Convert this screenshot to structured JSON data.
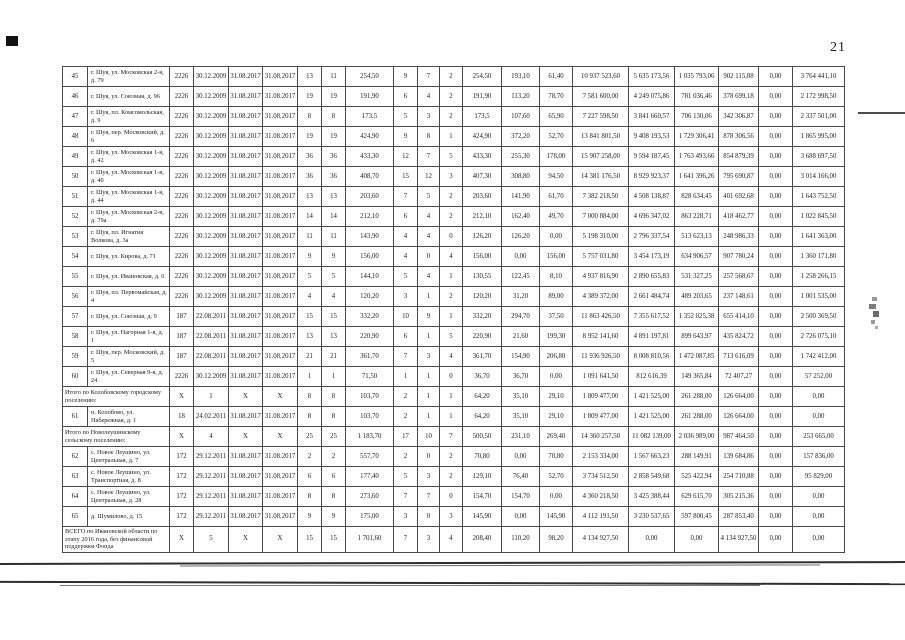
{
  "page": {
    "number": "21"
  },
  "table": {
    "rows": [
      {
        "kind": "data",
        "cells": [
          "45",
          "г. Шуя, ул. Московская 2-я, д. 79",
          "2226",
          "30.12.2009",
          "31.08.2017",
          "31.08.2017",
          "13",
          "11",
          "254,50",
          "9",
          "7",
          "2",
          "254,50",
          "193,10",
          "61,40",
          "10 937 523,60",
          "5 635 173,56",
          "1 035 793,06",
          "902 115,88",
          "0,00",
          "3 764 441,10"
        ]
      },
      {
        "kind": "data",
        "cells": [
          "46",
          "г. Шуя, ул. Союзная, д. 96",
          "2226",
          "30.12.2009",
          "31.08.2017",
          "31.08.2017",
          "19",
          "19",
          "191,90",
          "6",
          "4",
          "2",
          "191,90",
          "113,20",
          "78,70",
          "7 581 600,00",
          "4 249 075,86",
          "781 036,46",
          "378 699,18",
          "0,00",
          "2 172 998,50"
        ]
      },
      {
        "kind": "data",
        "cells": [
          "47",
          "г. Шуя, пл. Комсомольская, д. 9",
          "2226",
          "30.12.2009",
          "31.08.2017",
          "31.08.2017",
          "8",
          "8",
          "173,5",
          "5",
          "3",
          "2",
          "173,5",
          "107,60",
          "65,90",
          "7 227 598,50",
          "3 841 660,57",
          "706 130,06",
          "342 306,87",
          "0,00",
          "2 337 501,00"
        ]
      },
      {
        "kind": "data",
        "cells": [
          "48",
          "г. Шуя, пер. Московский, д. 6",
          "2226",
          "30.12.2009",
          "31.08.2017",
          "31.08.2017",
          "19",
          "19",
          "424,90",
          "9",
          "8",
          "1",
          "424,90",
          "372,20",
          "52,70",
          "13 841 801,50",
          "9 408 193,53",
          "1 729 306,41",
          "878 306,56",
          "0,00",
          "1 865 995,00"
        ]
      },
      {
        "kind": "data",
        "cells": [
          "49",
          "г. Шуя, ул. Московская 1-я, д. 42",
          "2226",
          "30.12.2009",
          "31.08.2017",
          "31.08.2017",
          "36",
          "36",
          "433,30",
          "12",
          "7",
          "5",
          "433,30",
          "255,30",
          "178,00",
          "15 907 258,00",
          "9 594 187,45",
          "1 763 493,66",
          "854 879,39",
          "0,00",
          "3 688 697,50"
        ]
      },
      {
        "kind": "data",
        "cells": [
          "50",
          "г. Шуя, ул. Московская 1-я, д. 40",
          "2226",
          "30.12.2009",
          "31.08.2017",
          "31.08.2017",
          "36",
          "36",
          "408,70",
          "15",
          "12",
          "3",
          "407,30",
          "308,80",
          "94,50",
          "14 381 176,50",
          "8 929 923,37",
          "1 641 396,26",
          "795 690,87",
          "0,00",
          "3 014 166,00"
        ]
      },
      {
        "kind": "data",
        "cells": [
          "51",
          "г. Шуя, ул. Московская 1-я, д. 44",
          "2226",
          "30.12.2009",
          "31.08.2017",
          "31.08.2017",
          "13",
          "13",
          "203,60",
          "7",
          "5",
          "2",
          "203,60",
          "141,90",
          "61,70",
          "7 382 218,50",
          "4 508 138,87",
          "828 634,45",
          "401 692,68",
          "0,00",
          "1 643 752,50"
        ]
      },
      {
        "kind": "data",
        "cells": [
          "52",
          "г. Шуя, ул. Московская 2-я, д. 79а",
          "2226",
          "30.12.2009",
          "31.08.2017",
          "31.08.2017",
          "14",
          "14",
          "212,10",
          "6",
          "4",
          "2",
          "212,10",
          "162,40",
          "49,70",
          "7 000 884,00",
          "4 696 347,02",
          "863 228,71",
          "418 462,77",
          "0,00",
          "1 022 845,50"
        ]
      },
      {
        "kind": "data",
        "cells": [
          "53",
          "г. Шуя, пл. Игнатия Волкова, д. 3а",
          "2226",
          "30.12.2009",
          "31.08.2017",
          "31.08.2017",
          "11",
          "11",
          "143,90",
          "4",
          "4",
          "0",
          "126,20",
          "126,20",
          "0,00",
          "5 198 310,00",
          "2 796 337,54",
          "513 623,13",
          "248 986,33",
          "0,00",
          "1 641 363,00"
        ]
      },
      {
        "kind": "data",
        "cells": [
          "54",
          "г. Шуя, ул. Кирова, д. 71",
          "2226",
          "30.12.2009",
          "31.08.2017",
          "31.08.2017",
          "9",
          "9",
          "156,00",
          "4",
          "0",
          "4",
          "156,00",
          "0,00",
          "156,00",
          "5 757 031,80",
          "3 454 173,19",
          "634 906,57",
          "907 780,24",
          "0,00",
          "1 360 171,80"
        ]
      },
      {
        "kind": "data",
        "cells": [
          "55",
          "г. Шуя, ул. Ивановская, д. 6",
          "2226",
          "30.12.2009",
          "31.08.2017",
          "31.08.2017",
          "5",
          "5",
          "144,10",
          "5",
          "4",
          "1",
          "130,55",
          "122,45",
          "8,10",
          "4 937 816,90",
          "2 890 655,83",
          "531 327,25",
          "257 568,67",
          "0,00",
          "1 258 266,15"
        ]
      },
      {
        "kind": "data",
        "cells": [
          "56",
          "г. Шуя, пл. Первомайская, д. 4",
          "2226",
          "30.12.2009",
          "31.08.2017",
          "31.08.2017",
          "4",
          "4",
          "120,20",
          "3",
          "1",
          "2",
          "120,20",
          "31,20",
          "89,00",
          "4 389 372,00",
          "2 661 484,74",
          "489 203,65",
          "237 148,61",
          "0,00",
          "1 001 535,00"
        ]
      },
      {
        "kind": "data",
        "cells": [
          "57",
          "г. Шуя, ул. Союзная, д. 9",
          "187",
          "22.08.2011",
          "31.08.2017",
          "31.08.2017",
          "15",
          "15",
          "332,20",
          "10",
          "9",
          "1",
          "332,20",
          "294,70",
          "37,50",
          "11 863 426,50",
          "7 355 617,52",
          "1 352 025,38",
          "655 414,10",
          "0,00",
          "2 500 369,50"
        ]
      },
      {
        "kind": "data",
        "cells": [
          "58",
          "г. Шуя, ул. Нагорная 1-я, д. 1",
          "187",
          "22.08.2011",
          "31.08.2017",
          "31.08.2017",
          "13",
          "13",
          "220,90",
          "6",
          "1",
          "5",
          "220,90",
          "21,60",
          "199,30",
          "8 952 141,60",
          "4 891 197,81",
          "899 643,97",
          "435 824,72",
          "0,00",
          "2 726 075,10"
        ]
      },
      {
        "kind": "data",
        "cells": [
          "59",
          "г. Шуя, пер. Московский, д. 5",
          "187",
          "22.08.2011",
          "31.08.2017",
          "31.08.2017",
          "21",
          "21",
          "361,70",
          "7",
          "3",
          "4",
          "361,70",
          "154,90",
          "206,80",
          "11 936 926,50",
          "8 008 810,56",
          "1 472 087,85",
          "713 616,09",
          "0,00",
          "1 742 412,00"
        ]
      },
      {
        "kind": "data",
        "cells": [
          "60",
          "г. Шуя, ул. Северная 9-я, д. 24",
          "2226",
          "30.12.2009",
          "31.08.2017",
          "31.08.2017",
          "1",
          "1",
          "71,50",
          "1",
          "1",
          "0",
          "36,70",
          "36,70",
          "0,00",
          "1 091 641,50",
          "812 616,39",
          "149 365,84",
          "72 407,27",
          "0,00",
          "57 252,00"
        ]
      },
      {
        "kind": "summary",
        "cells": [
          "Итого по Колобовскому городскому поселению:",
          "X",
          "1",
          "X",
          "X",
          "8",
          "8",
          "103,70",
          "2",
          "1",
          "1",
          "64,20",
          "35,10",
          "29,10",
          "1 809 477,00",
          "1 421 525,00",
          "261 288,00",
          "126 664,00",
          "0,00",
          "0,00"
        ]
      },
      {
        "kind": "data",
        "cells": [
          "61",
          "п. Колобово, ул. Набережная, д. 1",
          "18",
          "24.02.2011",
          "31.08.2017",
          "31.08.2017",
          "8",
          "8",
          "103,70",
          "2",
          "1",
          "1",
          "64,20",
          "35,10",
          "29,10",
          "1 809 477,00",
          "1 421 525,00",
          "261 288,00",
          "126 664,00",
          "0,00",
          "0,00"
        ]
      },
      {
        "kind": "summary",
        "cells": [
          "Итого по Новолеушинскому сельскому поселению:",
          "X",
          "4",
          "X",
          "X",
          "25",
          "25",
          "1 183,70",
          "17",
          "10",
          "7",
          "500,50",
          "231,10",
          "269,40",
          "14 360 257,50",
          "11 082 139,00",
          "2 036 989,00",
          "987 464,50",
          "0,00",
          "253 665,00"
        ]
      },
      {
        "kind": "data",
        "cells": [
          "62",
          "с. Новое Леушино, ул. Центральная, д. 7",
          "172",
          "29.12.2011",
          "31.08.2017",
          "31.08.2017",
          "2",
          "2",
          "557,70",
          "2",
          "0",
          "2",
          "70,80",
          "0,00",
          "70,80",
          "2 153 334,00",
          "1 567 663,23",
          "288 149,91",
          "139 684,86",
          "0,00",
          "157 836,00"
        ]
      },
      {
        "kind": "data",
        "cells": [
          "63",
          "с. Новое Леушино, ул. Транспортная, д. 8",
          "172",
          "29.12.2011",
          "31.08.2017",
          "31.08.2017",
          "6",
          "6",
          "177,40",
          "5",
          "3",
          "2",
          "129,10",
          "76,40",
          "52,70",
          "3 734 512,50",
          "2 858 549,68",
          "525 422,94",
          "254 710,88",
          "0,00",
          "95 829,00"
        ]
      },
      {
        "kind": "data",
        "cells": [
          "64",
          "с. Новое Леушино, ул. Центральная, д. 28",
          "172",
          "29.12.2011",
          "31.08.2017",
          "31.08.2017",
          "8",
          "8",
          "273,60",
          "7",
          "7",
          "0",
          "154,70",
          "154,70",
          "0,00",
          "4 360 218,50",
          "3 425 388,44",
          "629 615,70",
          "305 215,36",
          "0,00",
          "0,00"
        ]
      },
      {
        "kind": "data",
        "cells": [
          "65",
          "д. Шумилово, д. 15",
          "172",
          "29.12.2011",
          "31.08.2017",
          "31.08.2017",
          "9",
          "9",
          "175,00",
          "3",
          "0",
          "3",
          "145,90",
          "0,00",
          "145,90",
          "4 112 191,50",
          "3 230 537,65",
          "597 800,45",
          "287 853,40",
          "0,00",
          "0,00"
        ]
      },
      {
        "kind": "summary",
        "cells": [
          "ВСЕГО по Ивановской области по этапу 2016 года, без финансовой поддержки Фонда",
          "X",
          "5",
          "X",
          "X",
          "15",
          "15",
          "1 701,60",
          "7",
          "3",
          "4",
          "208,40",
          "110,20",
          "98,20",
          "4 134 927,50",
          "0,00",
          "0,00",
          "4 134 927,50",
          "0,00",
          "0,00"
        ]
      }
    ]
  }
}
